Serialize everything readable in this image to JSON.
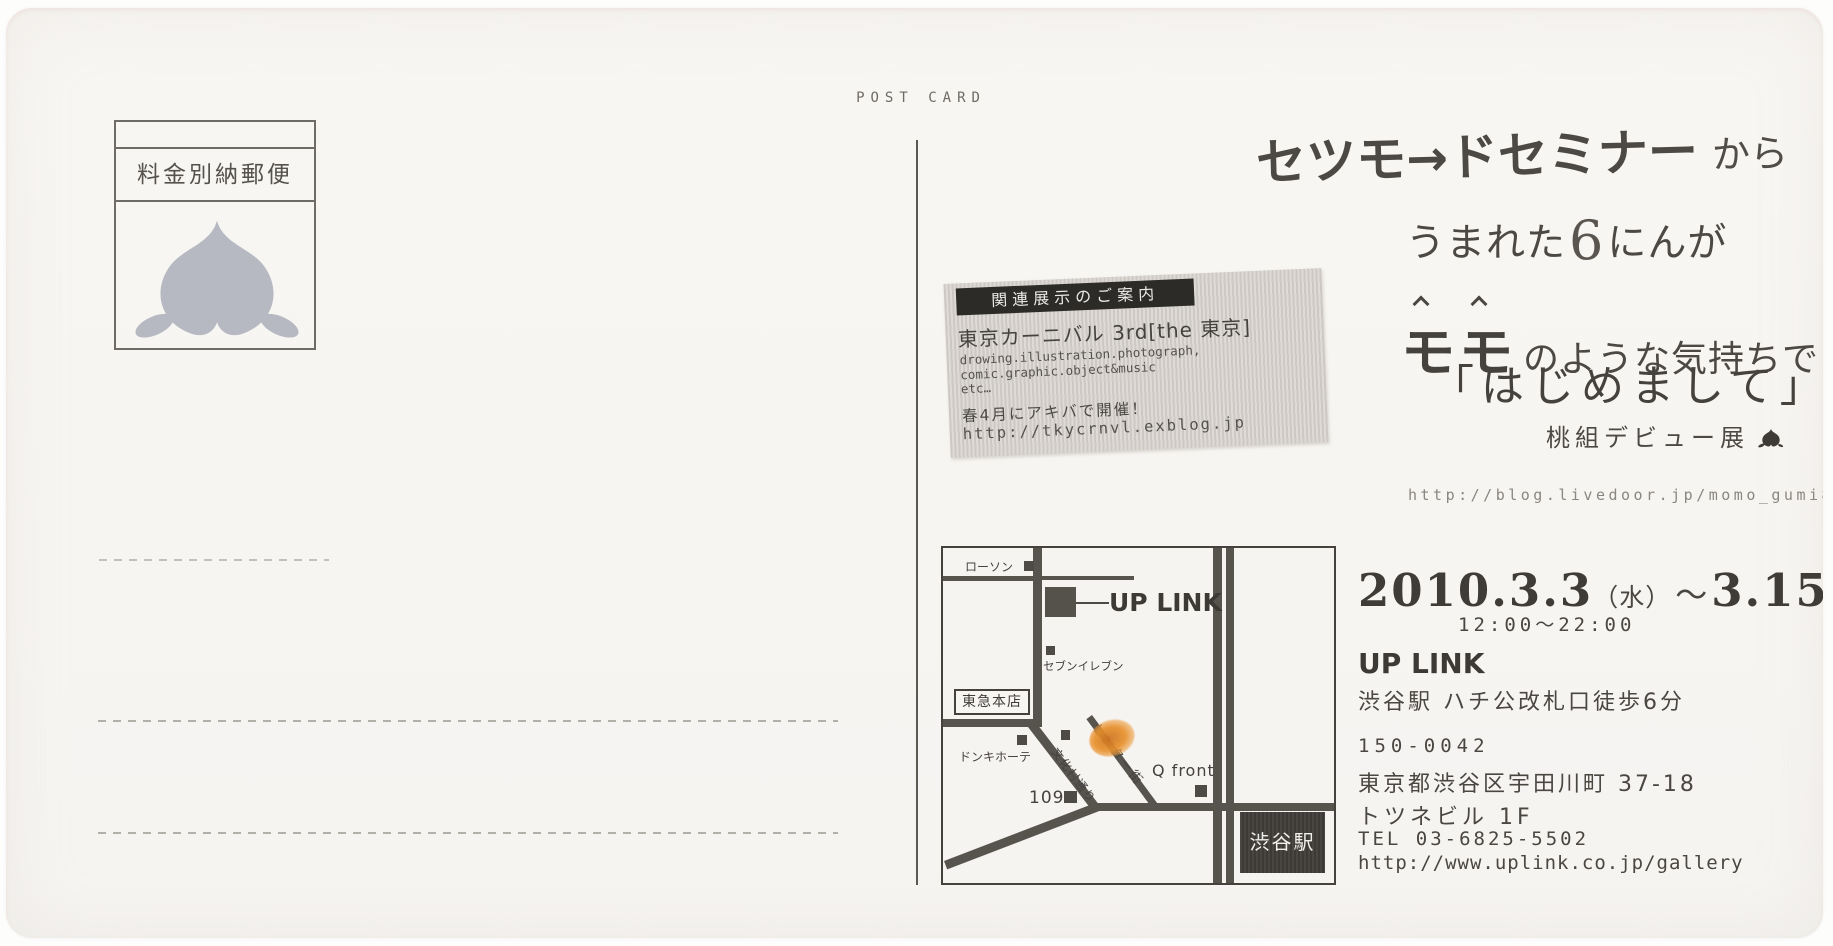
{
  "colors": {
    "ink": "#4a4641",
    "road": "#57544e",
    "sticker_bg": "#d9d5d0",
    "marker_orange": "#e8912c",
    "stamp_peach_gray": "#b6b9c1"
  },
  "postcard": {
    "post_card": "POST CARD",
    "stamp_label": "料金別納郵便",
    "headline": {
      "line1_main": "セツモ→ドセミナー",
      "line1_suffix": "から",
      "line2_pre": "うまれた",
      "line2_num": "6",
      "line2_post": "にんが",
      "line3_momo_1": "モ",
      "line3_momo_2": "モ",
      "line3_rest": "のような気持ちで",
      "line4": "「はじめまして」",
      "line5": "桃組デビュー展",
      "blog_url": "http://blog.livedoor.jp/momo_gumi8/"
    },
    "sticker": {
      "header": "関連展示のご案内",
      "title": "東京カーニバル 3rd[the 東京]",
      "desc1": "drowing.illustration.photograph,",
      "desc2": "comic.graphic.object&music",
      "desc3": "etc…",
      "note": "春4月にアキバで開催！",
      "url": "http://tkycrnvl.exblog.jp"
    },
    "map": {
      "lawson": "ローソン",
      "uplink": "UP LINK",
      "seven_eleven": "セブンイレブン",
      "tokyu": "東急本店",
      "donki": "ドンキホーテ",
      "bunkamura_street": "文化村通り",
      "center_gai": "センター街",
      "one_o_nine": "109",
      "qfront": "Q front",
      "shibuya_station": "渋谷駅"
    },
    "details": {
      "date_start": "2010.3.3",
      "date_start_dow": "（水）",
      "date_tilde": "～",
      "date_end": "3.15",
      "date_end_dow": "（月）",
      "hours": "12:00～22:00",
      "venue": "UP LINK",
      "access": "渋谷駅 ハチ公改札口徒歩6分",
      "postal_code": "150-0042",
      "address_line1": "東京都渋谷区宇田川町 37-18",
      "address_line2": "トツネビル 1F",
      "tel": "TEL 03-6825-5502",
      "site_url": "http://www.uplink.co.jp/gallery"
    }
  }
}
